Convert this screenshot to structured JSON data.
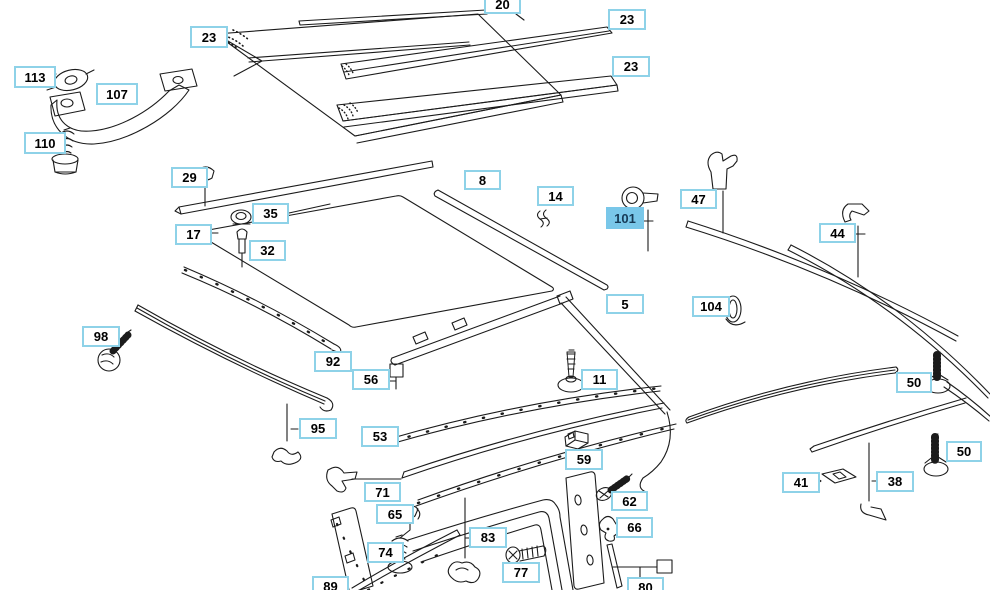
{
  "diagram": {
    "type": "exploded-parts-diagram",
    "subject": "vehicle roof / hardtop mouldings and trim strips",
    "background_color": "#ffffff",
    "line_color": "#1b1b1b",
    "callout_style": {
      "border": "#8ed2e8",
      "fill": "#ffffff",
      "text": "#000000"
    },
    "highlight_style": {
      "fill": "#79c7e9",
      "text": "#163a56"
    },
    "selected_part": "101",
    "callouts": [
      {
        "label": "23",
        "x": 190,
        "y": 26,
        "w": 38,
        "h": 22,
        "highlighted": false
      },
      {
        "label": "20",
        "x": 484,
        "y": -6,
        "w": 37,
        "h": 20,
        "highlighted": false
      },
      {
        "label": "23",
        "x": 608,
        "y": 9,
        "w": 38,
        "h": 21,
        "highlighted": false
      },
      {
        "label": "23",
        "x": 612,
        "y": 56,
        "w": 38,
        "h": 21,
        "highlighted": false
      },
      {
        "label": "113",
        "x": 14,
        "y": 66,
        "w": 42,
        "h": 22,
        "highlighted": false
      },
      {
        "label": "107",
        "x": 96,
        "y": 83,
        "w": 42,
        "h": 22,
        "highlighted": false
      },
      {
        "label": "110",
        "x": 24,
        "y": 132,
        "w": 42,
        "h": 22,
        "highlighted": false
      },
      {
        "label": "29",
        "x": 171,
        "y": 167,
        "w": 37,
        "h": 21,
        "highlighted": false
      },
      {
        "label": "17",
        "x": 175,
        "y": 224,
        "w": 37,
        "h": 21,
        "highlighted": false
      },
      {
        "label": "35",
        "x": 252,
        "y": 203,
        "w": 37,
        "h": 21,
        "highlighted": false
      },
      {
        "label": "32",
        "x": 249,
        "y": 240,
        "w": 37,
        "h": 21,
        "highlighted": false
      },
      {
        "label": "8",
        "x": 464,
        "y": 170,
        "w": 37,
        "h": 20,
        "highlighted": false
      },
      {
        "label": "14",
        "x": 537,
        "y": 186,
        "w": 37,
        "h": 20,
        "highlighted": false
      },
      {
        "label": "101",
        "x": 606,
        "y": 207,
        "w": 38,
        "h": 22,
        "highlighted": true
      },
      {
        "label": "47",
        "x": 680,
        "y": 189,
        "w": 37,
        "h": 20,
        "highlighted": false
      },
      {
        "label": "44",
        "x": 819,
        "y": 223,
        "w": 37,
        "h": 20,
        "highlighted": false
      },
      {
        "label": "104",
        "x": 692,
        "y": 296,
        "w": 38,
        "h": 21,
        "highlighted": false
      },
      {
        "label": "5",
        "x": 606,
        "y": 294,
        "w": 38,
        "h": 20,
        "highlighted": false
      },
      {
        "label": "11",
        "x": 581,
        "y": 369,
        "w": 37,
        "h": 21,
        "highlighted": false
      },
      {
        "label": "50",
        "x": 896,
        "y": 372,
        "w": 36,
        "h": 21,
        "highlighted": false
      },
      {
        "label": "50",
        "x": 946,
        "y": 441,
        "w": 36,
        "h": 21,
        "highlighted": false
      },
      {
        "label": "98",
        "x": 82,
        "y": 326,
        "w": 38,
        "h": 21,
        "highlighted": false
      },
      {
        "label": "92",
        "x": 314,
        "y": 351,
        "w": 38,
        "h": 21,
        "highlighted": false
      },
      {
        "label": "56",
        "x": 352,
        "y": 369,
        "w": 38,
        "h": 21,
        "highlighted": false
      },
      {
        "label": "95",
        "x": 299,
        "y": 418,
        "w": 38,
        "h": 21,
        "highlighted": false
      },
      {
        "label": "53",
        "x": 361,
        "y": 426,
        "w": 38,
        "h": 21,
        "highlighted": false
      },
      {
        "label": "71",
        "x": 364,
        "y": 482,
        "w": 37,
        "h": 20,
        "highlighted": false
      },
      {
        "label": "65",
        "x": 376,
        "y": 504,
        "w": 38,
        "h": 20,
        "highlighted": false
      },
      {
        "label": "74",
        "x": 367,
        "y": 542,
        "w": 37,
        "h": 21,
        "highlighted": false
      },
      {
        "label": "89",
        "x": 312,
        "y": 576,
        "w": 37,
        "h": 21,
        "highlighted": false
      },
      {
        "label": "59",
        "x": 565,
        "y": 449,
        "w": 38,
        "h": 21,
        "highlighted": false
      },
      {
        "label": "62",
        "x": 611,
        "y": 491,
        "w": 37,
        "h": 20,
        "highlighted": false
      },
      {
        "label": "66",
        "x": 616,
        "y": 517,
        "w": 37,
        "h": 21,
        "highlighted": false
      },
      {
        "label": "83",
        "x": 469,
        "y": 527,
        "w": 38,
        "h": 21,
        "highlighted": false
      },
      {
        "label": "77",
        "x": 502,
        "y": 562,
        "w": 38,
        "h": 21,
        "highlighted": false
      },
      {
        "label": "80",
        "x": 627,
        "y": 577,
        "w": 37,
        "h": 21,
        "highlighted": false
      },
      {
        "label": "41",
        "x": 782,
        "y": 472,
        "w": 38,
        "h": 21,
        "highlighted": false
      },
      {
        "label": "38",
        "x": 876,
        "y": 471,
        "w": 38,
        "h": 21,
        "highlighted": false
      }
    ]
  }
}
